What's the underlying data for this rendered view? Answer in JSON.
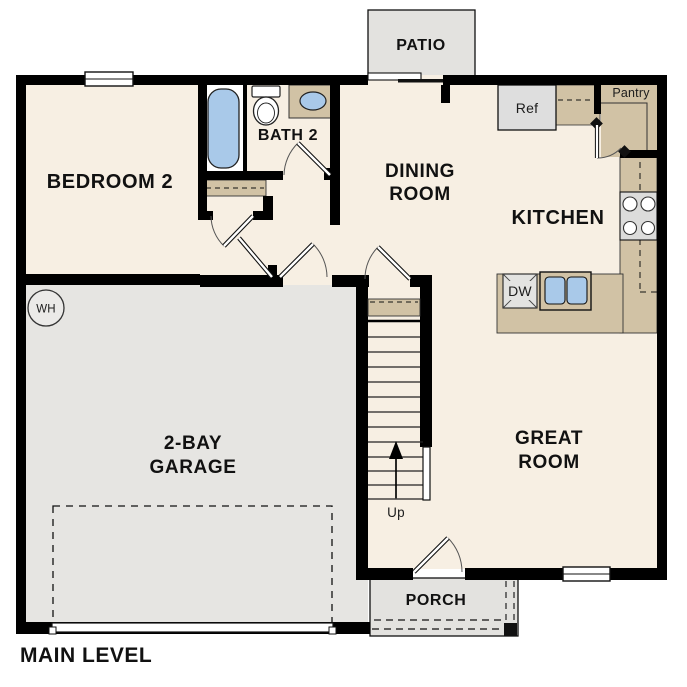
{
  "title": "MAIN LEVEL",
  "colors": {
    "wall": "#000000",
    "floor": "#f7efe3",
    "garage_floor": "#e6e5e2",
    "concrete": "#e3e2df",
    "counter": "#d1c2a5",
    "fixture_blue": "#a9c9e9",
    "appliance_gray": "#dedede",
    "white": "#ffffff",
    "text": "#111111"
  },
  "rooms": {
    "bedroom2": {
      "label": "BEDROOM 2"
    },
    "bath2": {
      "label": "BATH 2"
    },
    "dining": {
      "lines": [
        "DINING",
        "ROOM"
      ]
    },
    "kitchen": {
      "label": "KITCHEN"
    },
    "great_room": {
      "lines": [
        "GREAT",
        "ROOM"
      ]
    },
    "garage": {
      "lines": [
        "2-BAY",
        "GARAGE"
      ]
    },
    "patio": {
      "label": "PATIO"
    },
    "porch": {
      "label": "PORCH"
    },
    "pantry": {
      "label": "Pantry"
    }
  },
  "fixtures": {
    "refrigerator": {
      "label": "Ref"
    },
    "dishwasher": {
      "label": "DW"
    },
    "water_heater": {
      "label": "WH"
    },
    "stairs": {
      "direction_label": "Up"
    }
  }
}
